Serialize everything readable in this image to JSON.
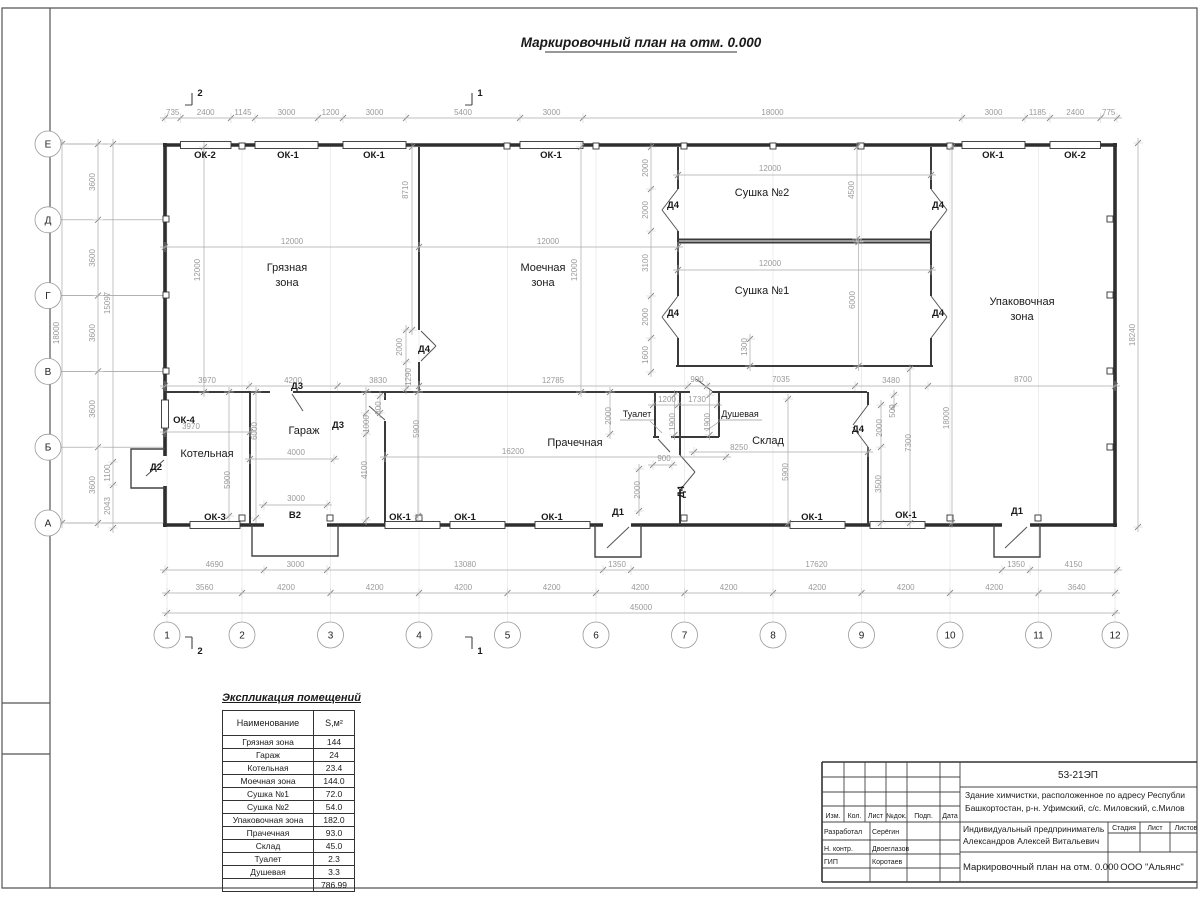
{
  "sheet": {
    "title": "Маркировочный план на отм. 0.000"
  },
  "axes": {
    "letters": [
      "Е",
      "Д",
      "Г",
      "В",
      "Б",
      "А"
    ],
    "numbers": [
      "1",
      "2",
      "3",
      "4",
      "5",
      "6",
      "7",
      "8",
      "9",
      "10",
      "11",
      "12"
    ]
  },
  "sections": {
    "one": "1",
    "two": "2"
  },
  "openings": {
    "ok1": "ОК-1",
    "ok2": "ОК-2",
    "ok3": "ОК-3",
    "ok4": "ОК-4",
    "d1": "Д1",
    "d2": "Д2",
    "d3": "Д3",
    "d4": "Д4",
    "v2": "В2"
  },
  "rooms": {
    "dirty1": "Грязная",
    "dirty2": "зона",
    "wash1": "Моечная",
    "wash2": "зона",
    "dry2": "Сушка №2",
    "dry1": "Сушка №1",
    "pack1": "Упаковочная",
    "pack2": "зона",
    "boiler": "Котельная",
    "garage": "Гараж",
    "laundry": "Прачечная",
    "toilet": "Туалет",
    "shower": "Душевая",
    "storage": "Склад"
  },
  "dims": {
    "top": [
      "735",
      "2400",
      "1145",
      "3000",
      "1200",
      "3000",
      "5400",
      "3000",
      "18000",
      "3000",
      "1185",
      "2400",
      "775"
    ],
    "bottom1": [
      "4690",
      "3000",
      "13080",
      "1350",
      "17620",
      "1350",
      "4150"
    ],
    "bottom2": [
      "3560",
      "4200",
      "4200",
      "4200",
      "4200",
      "4200",
      "4200",
      "4200",
      "4200",
      "4200",
      "3640"
    ],
    "total": "45000",
    "left": [
      "18000",
      "3600",
      "3600",
      "3600",
      "3600",
      "3600",
      "15097",
      "1100",
      "2043"
    ],
    "right": [
      "18240"
    ],
    "inner": [
      "12000",
      "12000",
      "8710",
      "2000",
      "1290",
      "3970",
      "4200",
      "3830",
      "12000",
      "12000",
      "12785",
      "2000",
      "2000",
      "3100",
      "2000",
      "1600",
      "12000",
      "4500",
      "12000",
      "6000",
      "1300",
      "900",
      "7035",
      "3480",
      "8700",
      "18000",
      "3970",
      "5900",
      "6000",
      "4000",
      "3000",
      "1000",
      "800",
      "4100",
      "5900",
      "16200",
      "2000",
      "1200",
      "1730",
      "1900",
      "1900",
      "900",
      "2000",
      "8250",
      "5900",
      "500",
      "2000",
      "3500",
      "7300"
    ]
  },
  "exp_table": {
    "title": "Экспликация помещений",
    "col1": "Наименование",
    "col2": "S,м²",
    "rows": [
      [
        "Грязная зона",
        "144"
      ],
      [
        "Гараж",
        "24"
      ],
      [
        "Котельная",
        "23.4"
      ],
      [
        "Моечная зона",
        "144.0"
      ],
      [
        "Сушка №1",
        "72.0"
      ],
      [
        "Сушка №2",
        "54.0"
      ],
      [
        "Упаковочная зона",
        "182.0"
      ],
      [
        "Прачечная",
        "93.0"
      ],
      [
        "Склад",
        "45.0"
      ],
      [
        "Туалет",
        "2.3"
      ],
      [
        "Душевая",
        "3.3"
      ]
    ],
    "total": "786.99"
  },
  "titleblock": {
    "code": "53-21ЭП",
    "desc1": "Здание химчистки,  расположенное по адресу Республи",
    "desc2": "Башкортостан, р-н. Уфимский, с/с. Миловский, с.Милов",
    "hdr": [
      "Изм.",
      "Кол.",
      "Лист",
      "№док.",
      "Подп.",
      "Дата"
    ],
    "roles": [
      [
        "Разработал",
        "Серёгин"
      ],
      [
        "Н. контр.",
        "Двоеглазов"
      ],
      [
        "ГИП",
        "Коротаев"
      ]
    ],
    "client1": "Индивидуальный предприниматель",
    "client2": "Александров Алексей Витальевич",
    "stage_hdr": [
      "Стадия",
      "Лист",
      "Листов"
    ],
    "drawing_title": "Маркировочный план на отм. 0.000",
    "org": "ООО \"Альянс\""
  }
}
